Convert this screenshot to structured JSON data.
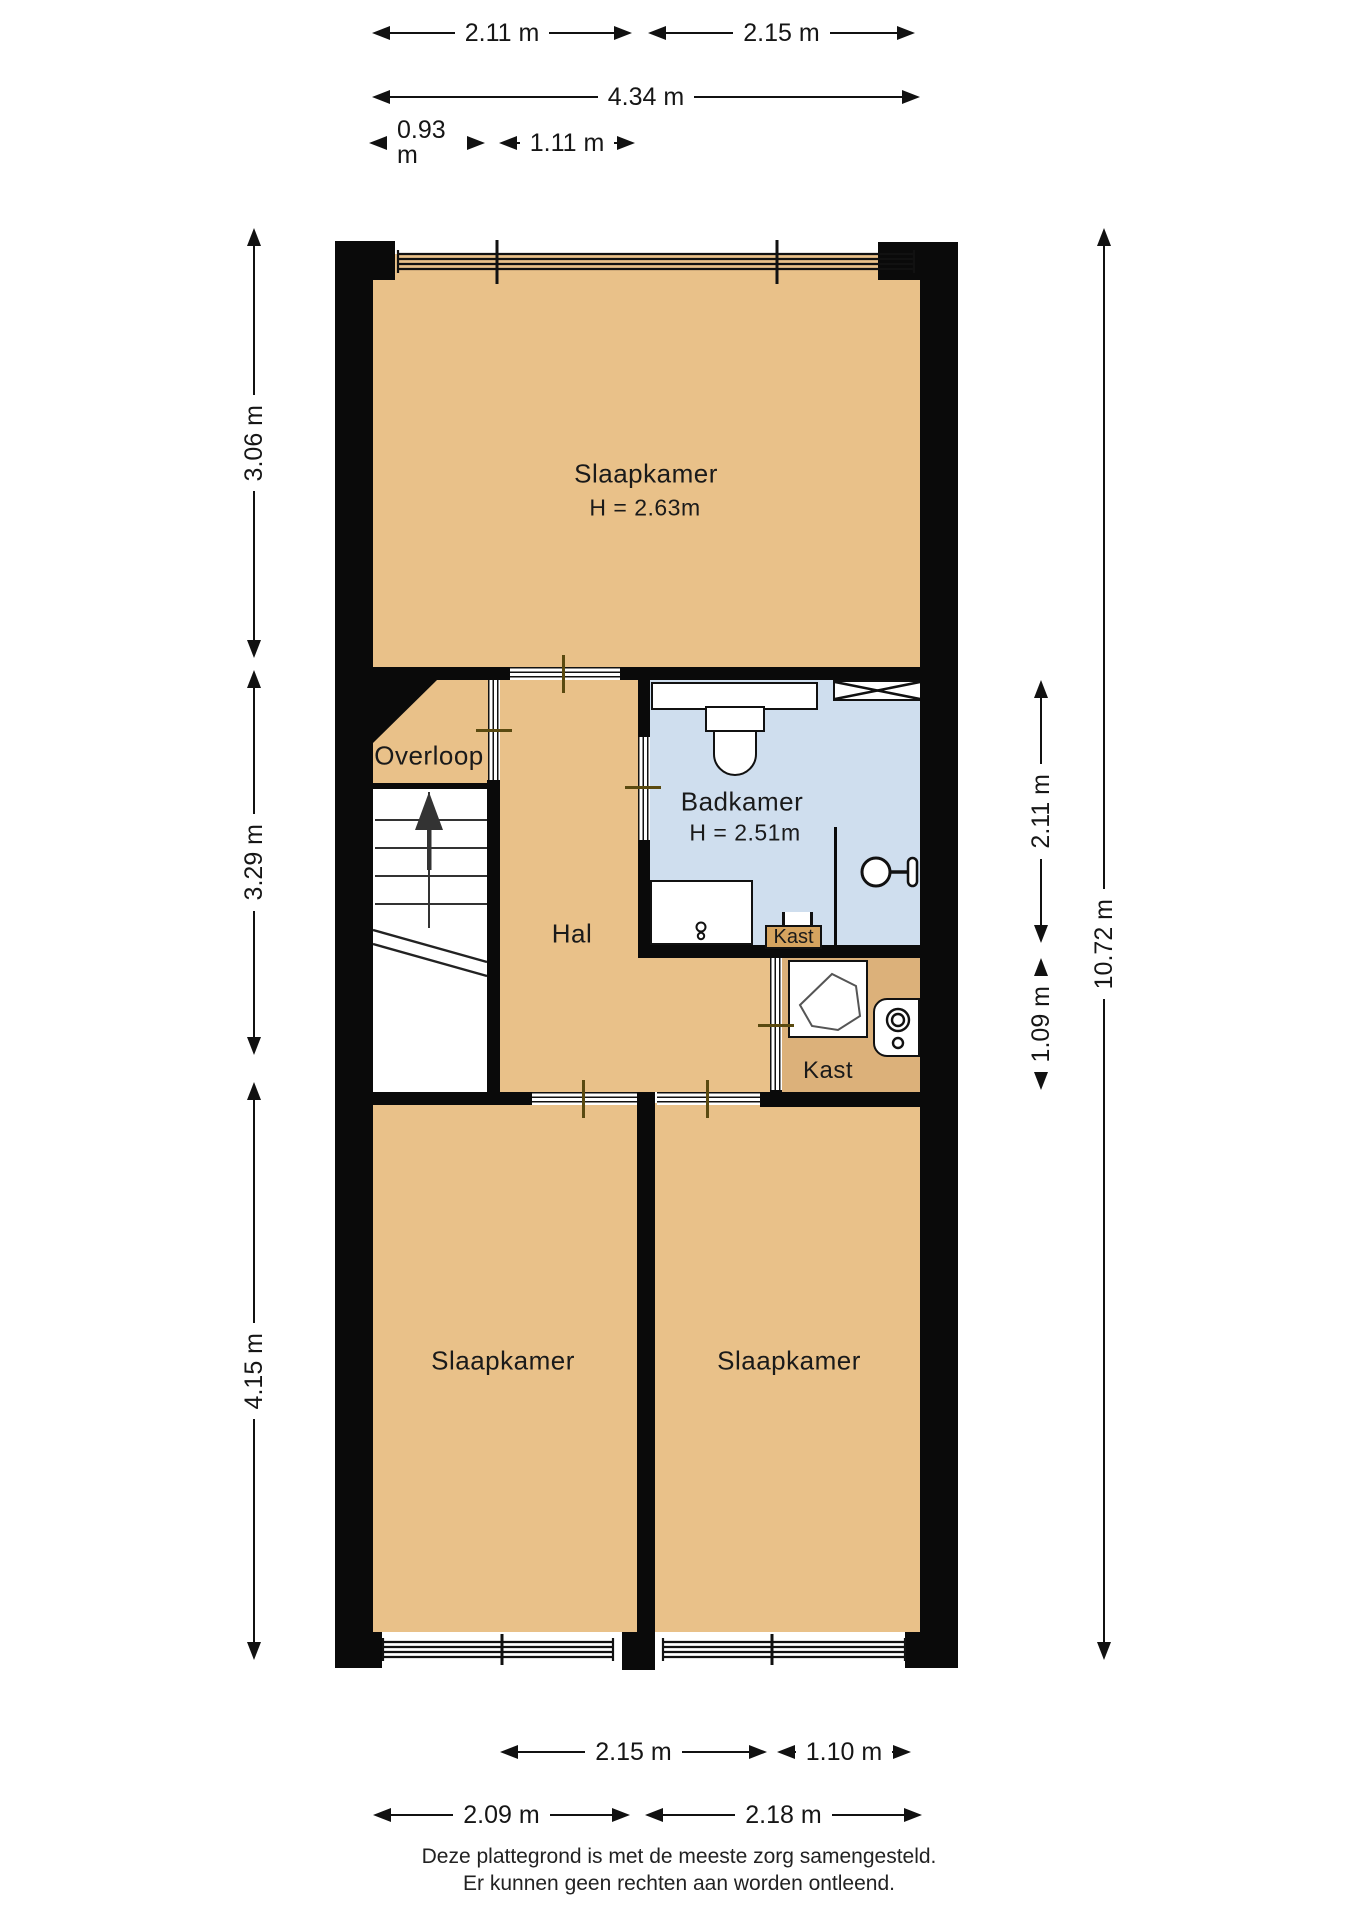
{
  "rooms": {
    "slaapkamer_boven": {
      "label": "Slaapkamer",
      "height_label": "H = 2.63m"
    },
    "overloop": {
      "label": "Overloop"
    },
    "hal": {
      "label": "Hal"
    },
    "badkamer": {
      "label": "Badkamer",
      "height_label": "H = 2.51m"
    },
    "kast_badkamer": {
      "label": "Kast"
    },
    "kast_achter": {
      "label": "Kast"
    },
    "slaapkamer_linksonder": {
      "label": "Slaapkamer"
    },
    "slaapkamer_rechtsonder": {
      "label": "Slaapkamer"
    }
  },
  "dimensions": {
    "top_row1_left": "2.11 m",
    "top_row1_right": "2.15 m",
    "top_row2": "4.34 m",
    "top_row3_left": "0.93 m",
    "top_row3_right": "1.11 m",
    "left_col": [
      "3.06 m",
      "3.29 m",
      "4.15 m"
    ],
    "right_col": {
      "badkamer": "2.11 m",
      "kast": "1.09 m",
      "totaal": "10.72 m"
    },
    "bottom_row1_left": "2.15 m",
    "bottom_row1_right": "1.10 m",
    "bottom_row2_left": "2.09 m",
    "bottom_row2_right": "2.18 m"
  },
  "footer": {
    "line1": "Deze plattegrond is met de meeste zorg samengesteld.",
    "line2": "Er kunnen geen rechten aan worden ontleend."
  },
  "icons": {
    "stairs_up_arrow": "stairs-direction-up",
    "toilet": "toilet-icon",
    "washbasin": "washbasin-icon",
    "shower": "shower-head-icon",
    "ventilation": "ventilation-duct-icon",
    "boiler": "boiler-unit-icon",
    "washer": "washing-machine-icon"
  },
  "colors": {
    "room_fill": "#e9c189",
    "closet_fill": "#dcb17a",
    "closet_label_fill": "#d6a45f",
    "bathroom_fill": "#cfdeee",
    "wall": "#0a0a0a"
  }
}
